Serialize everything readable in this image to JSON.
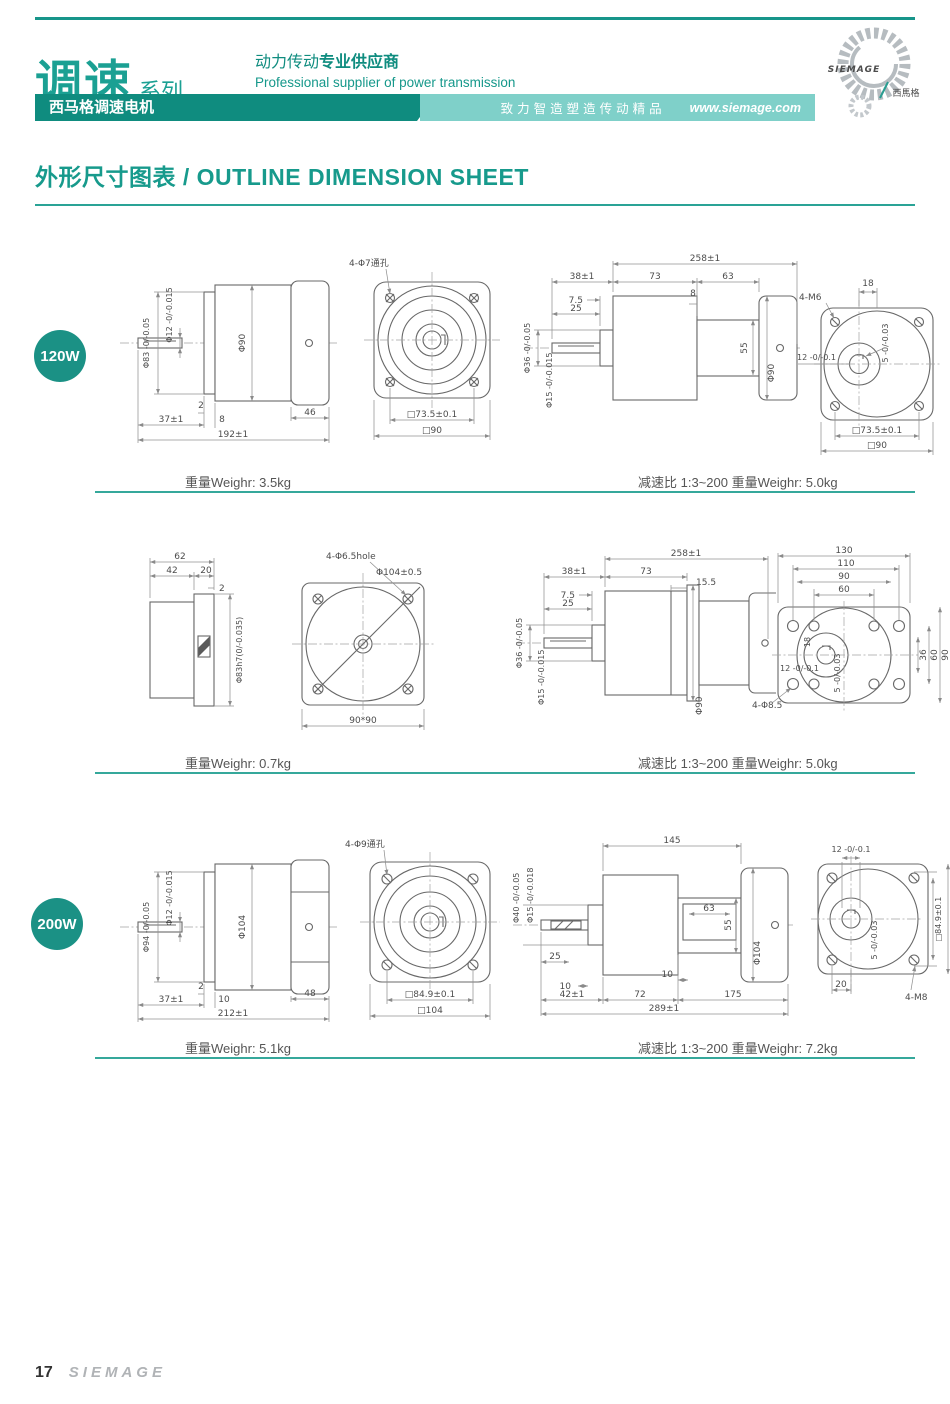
{
  "header": {
    "series_title": "调速",
    "series_suffix": "系列",
    "product_bar": "西马格调速电机",
    "supplier_cn_normal": "动力传动",
    "supplier_cn_bold": "专业供应商",
    "supplier_en": "Professional supplier of power transmission",
    "slogan": "致力智造塑造传动精品",
    "website": "www.siemage.com",
    "logo_text": "SIEMAGE",
    "logo_cn": "西馬格"
  },
  "page_title": "外形尺寸图表 / OUTLINE DIMENSION SHEET",
  "colors": {
    "accent": "#179a8c",
    "dark_bar": "#0f8c7f",
    "light_bar": "#7fd0c9",
    "badge": "#1b9185"
  },
  "rows": [
    {
      "badge": "120W",
      "caption_left": "重量Weighr: 3.5kg",
      "caption_right": "减速比 1:3~200  重量Weighr: 5.0kg",
      "d1": {
        "dia1": "Φ83 -0/-0.05",
        "dia2": "Φ12 -0/-0.015",
        "dia3": "Φ90",
        "t": "2",
        "l1": "37±1",
        "l2": "8",
        "l3": "46",
        "total": "192±1"
      },
      "d2": {
        "holes": "4-Φ7通孔",
        "sq1": "□73.5±0.1",
        "sq2": "□90"
      },
      "d3": {
        "total": "258±1",
        "l1": "38±1",
        "l2": "73",
        "l3": "63",
        "s1": "7.5",
        "s2": "8",
        "s3": "25",
        "dia1": "Φ36 -0/-0.05",
        "dia2": "Φ15 -0/-0.015",
        "h1": "55",
        "dia3": "Φ90"
      },
      "d4": {
        "off": "18",
        "bolt": "4-M6",
        "shaft": "12 -0/-0.1",
        "key": "5 -0/-0.03",
        "sq1": "□73.5±0.1",
        "sq2": "□90"
      }
    },
    {
      "badge": "",
      "caption_left": "重量Weighr: 0.7kg",
      "caption_right": "减速比 1:3~200  重量Weighr: 5.0kg",
      "d1": {
        "l1": "62",
        "l2": "42",
        "l3": "20",
        "t": "2",
        "dia": "Φ83h7(0/-0.035)"
      },
      "d2": {
        "holes": "4-Φ6.5hole",
        "dia": "Φ104±0.5",
        "sq": "90*90"
      },
      "d3": {
        "total": "258±1",
        "l1": "38±1",
        "l2": "73",
        "s1": "7.5",
        "s2": "15.5",
        "s3": "25",
        "dia1": "Φ36 -0/-0.05",
        "dia2": "Φ15 -0/-0.015",
        "dia3": "Φ90"
      },
      "d4": {
        "w1": "130",
        "w2": "110",
        "w3": "90",
        "w4": "60",
        "off": "18",
        "shaft": "12 -0/-0.1",
        "key": "5 -0/-0.03",
        "h1": "36",
        "h2": "60",
        "h3": "90",
        "bolt": "4-Φ8.5"
      }
    },
    {
      "badge": "200W",
      "caption_left": "重量Weighr: 5.1kg",
      "caption_right": "减速比 1:3~200  重量Weighr: 7.2kg",
      "d1": {
        "dia1": "Φ94 -0/-0.05",
        "dia2": "Φ12 -0/-0.015",
        "dia3": "Φ104",
        "t": "2",
        "l1": "37±1",
        "l2": "10",
        "l3": "48",
        "total": "212±1"
      },
      "d2": {
        "holes": "4-Φ9通孔",
        "sq1": "□84.9±0.1",
        "sq2": "□104"
      },
      "d3": {
        "dia1": "Φ40 -0/-0.05",
        "dia2": "Φ15 -0/-0.018",
        "l1": "145",
        "l2": "63",
        "h1": "55",
        "dia3": "Φ104",
        "s1": "25",
        "s2": "10",
        "s3": "10",
        "b1": "42±1",
        "b2": "72",
        "b3": "175",
        "total": "289±1"
      },
      "d4": {
        "shaft": "12 -0/-0.1",
        "key": "5 -0/-0.03",
        "sq1": "□84.9±0.1",
        "sq2": "□104",
        "off": "20",
        "bolt": "4-M8"
      }
    }
  ],
  "footer": {
    "page_number": "17",
    "brand": "SIEMAGE"
  }
}
